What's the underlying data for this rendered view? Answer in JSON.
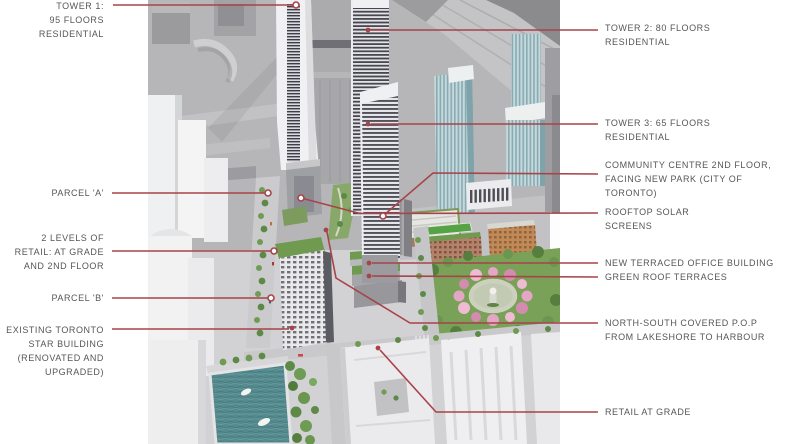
{
  "palette": {
    "leader_line": "#a8434a",
    "label_text": "#56565a",
    "render_background": "#b6b6b8",
    "greenery": "#6f9a4f",
    "water": "#558b8e",
    "blossom_pink": "#e3a6c5"
  },
  "annotations": {
    "tower1": {
      "text": "TOWER 1:\n95 FLOORS\nRESIDENTIAL"
    },
    "parcel_a": {
      "text": "PARCEL 'A'"
    },
    "retail_levels": {
      "text": "2 LEVELS OF\nRETAIL: AT GRADE\nAND 2ND FLOOR"
    },
    "parcel_b": {
      "text": "PARCEL 'B'"
    },
    "star_building": {
      "text": "EXISTING TORONTO\nSTAR BUILDING\n(RENOVATED AND\nUPGRADED)"
    },
    "tower2": {
      "text": "TOWER 2: 80 FLOORS\nRESIDENTIAL"
    },
    "tower3": {
      "text": "TOWER 3: 65 FLOORS\nRESIDENTIAL"
    },
    "community_centre": {
      "text": "COMMUNITY CENTRE 2ND FLOOR,\nFACING NEW PARK (CITY OF\nTORONTO)"
    },
    "rooftop_solar": {
      "text": "ROOFTOP SOLAR\nSCREENS"
    },
    "office_building": {
      "text": "NEW TERRACED OFFICE BUILDING\nGREEN ROOF TERRACES"
    },
    "pop_walkway": {
      "text": "NORTH-SOUTH COVERED P.O.P\nFROM LAKESHORE TO HARBOUR"
    },
    "retail_grade": {
      "text": "RETAIL AT GRADE"
    }
  }
}
